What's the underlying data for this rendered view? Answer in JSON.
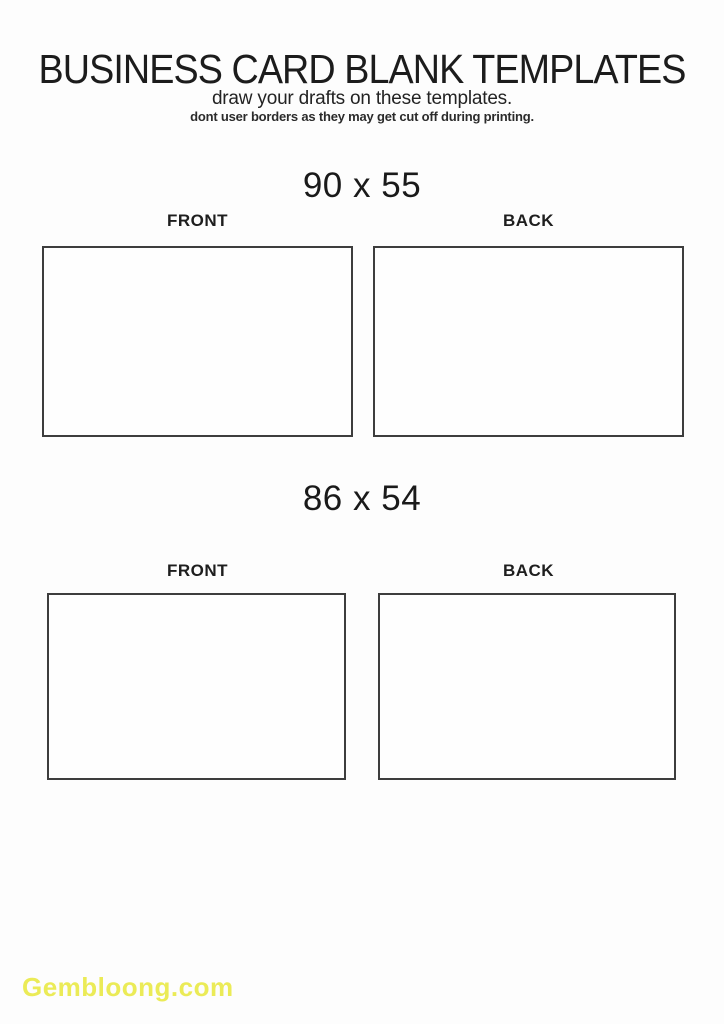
{
  "page": {
    "title": "BUSINESS CARD BLANK TEMPLATES",
    "subtitle": "draw your drafts on these templates.",
    "note": "dont user borders as they may get cut off during printing."
  },
  "sections": [
    {
      "size_label": "90 x 55",
      "front_label": "FRONT",
      "back_label": "BACK"
    },
    {
      "size_label": "86 x 54",
      "front_label": "FRONT",
      "back_label": "BACK"
    }
  ],
  "watermark": {
    "text": "Gembloong.com",
    "color": "#ebeb57"
  },
  "colors": {
    "background": "#fdfdfd",
    "text": "#1f1f1f",
    "card_border": "#3d3d3d"
  }
}
